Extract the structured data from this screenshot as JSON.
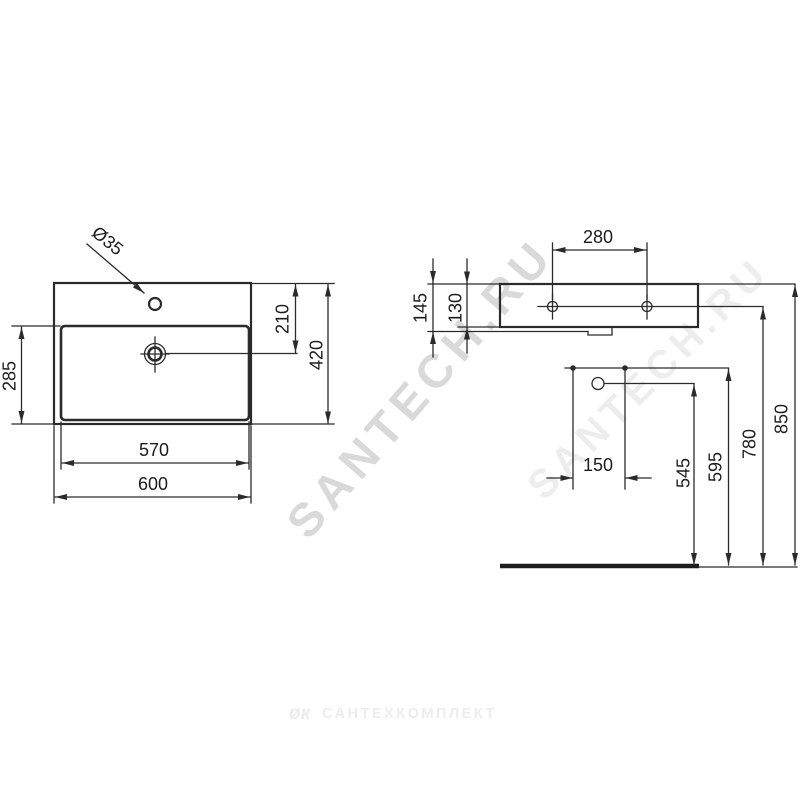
{
  "watermark": {
    "primary_text": "SANTECH.RU",
    "secondary_text": "SANTECH.RU"
  },
  "footer": {
    "logo_glyph": "øк",
    "brand_text": "САНТЕХКОМПЛЕКТ"
  },
  "drawing": {
    "front_view": {
      "tap_hole_diameter": "Ø35",
      "tap_hole_center_from_top": "210",
      "overall_depth": "420",
      "bowl_depth": "285",
      "bowl_width": "570",
      "overall_width": "600"
    },
    "rear_view": {
      "fixing_hole_spacing": "280",
      "edge_height_total": "145",
      "edge_height": "130"
    },
    "installation": {
      "tap_connection_spacing": "150",
      "waste_outlet_height": "545",
      "underside_height": "595",
      "fixing_hole_height": "780",
      "rim_height": "850"
    }
  }
}
